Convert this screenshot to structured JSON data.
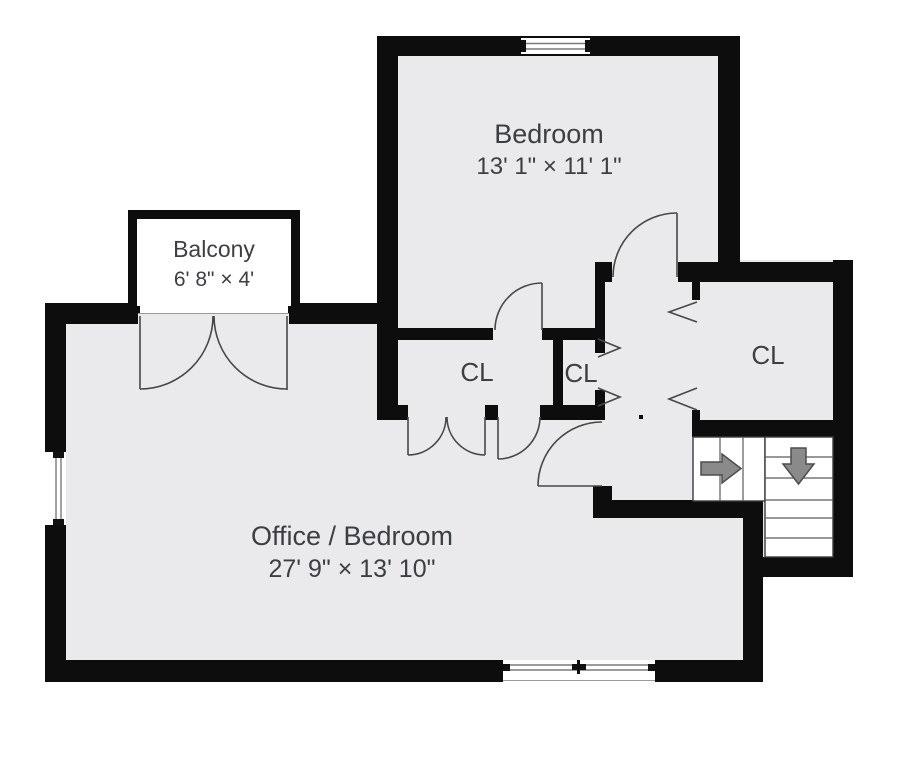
{
  "floorplan": {
    "type": "floor-plan",
    "rooms": {
      "bedroom": {
        "label": "Bedroom",
        "dimensions": "13' 1\" × 11' 1\""
      },
      "balcony": {
        "label": "Balcony",
        "dimensions": "6' 8\" × 4'"
      },
      "office": {
        "label": "Office / Bedroom",
        "dimensions": "27' 9\" × 13' 10\""
      },
      "closet_left": {
        "label": "CL"
      },
      "closet_middle": {
        "label": "CL"
      },
      "closet_right": {
        "label": "CL"
      }
    },
    "features": {
      "stairs": "L-shaped staircase with right arrow and down arrow",
      "windows": 3,
      "doors": "swing doors, french doors to balcony, bifold closet doors"
    },
    "colors": {
      "wall": "#0d0d0d",
      "floor": "#eaeaec",
      "balcony_floor": "#ffffff",
      "label_text": "#3c3f41",
      "stairs_arrow": "#8a8a8a",
      "door_line": "#474747"
    }
  }
}
